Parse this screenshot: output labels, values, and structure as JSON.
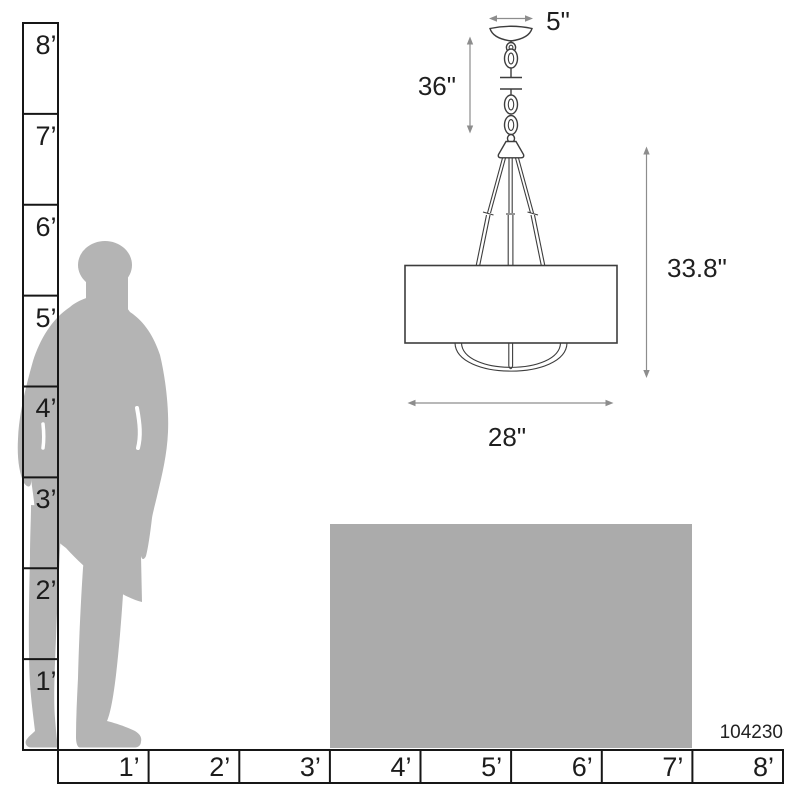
{
  "product": {
    "model_number": "104230"
  },
  "dimensions": {
    "canopy_width": "5\"",
    "chain_drop": "36\"",
    "fixture_height": "33.8\"",
    "shade_width": "28\""
  },
  "vertical_ruler": {
    "labels": [
      "8’",
      "7’",
      "6’",
      "5’",
      "4’",
      "3’",
      "2’",
      "1’"
    ]
  },
  "horizontal_ruler": {
    "labels": [
      "1’",
      "2’",
      "3’",
      "4’",
      "5’",
      "6’",
      "7’",
      "8’"
    ]
  },
  "colors": {
    "silhouette": "#b4b4b4",
    "table": "#ababab",
    "drawing_line": "#3d3d3d",
    "dimension_line": "#8d8d8d",
    "ruler_line": "#161616",
    "text": "#1c1c1c",
    "background": "#ffffff"
  }
}
